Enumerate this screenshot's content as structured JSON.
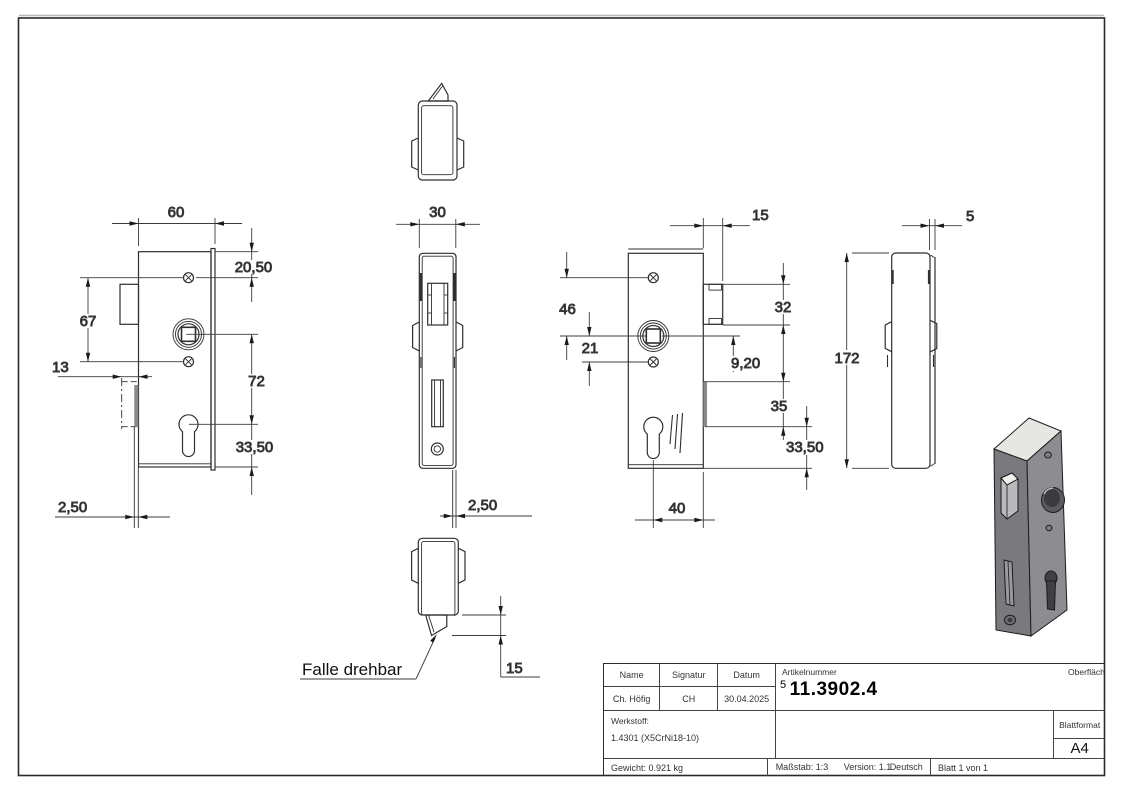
{
  "title_block": {
    "col_name": "Name",
    "col_signatur": "Signatur",
    "col_datum": "Datum",
    "name": "Ch. Höfig",
    "signatur": "CH",
    "datum": "30.04.2025",
    "artikelnummer_label": "Artikelnummer",
    "artikelnummer_prefix": "5",
    "artikelnummer": "11.3902.4",
    "oberflaeche_label": "Oberfläche:",
    "oberflaeche": "Geschliffen Korn 240",
    "werkstoff_label": "Werkstoff:",
    "werkstoff": "1.4301 (X5CrNi18-10)",
    "gewicht": "Gewicht: 0.921 kg",
    "massstab": "Maßstab: 1:3",
    "version": "Version: 1.1",
    "sprache": "Deutsch",
    "blatt": "Blatt 1 von 1",
    "blattformat_label": "Blattformat",
    "blattformat": "A4"
  },
  "annotations": {
    "falle": "Falle drehbar"
  },
  "dims": {
    "front": {
      "width": "60",
      "top_screw": "20,50",
      "screw_span": "67",
      "latch_depth": "13",
      "spindle_euro": "72",
      "euro_bottom": "33,50",
      "plate": "2,50"
    },
    "side": {
      "width": "30",
      "plate": "2,50"
    },
    "bottom": {
      "latch": "15"
    },
    "back": {
      "latch_offset": "15",
      "screw_spindle": "46",
      "spindle_screw": "21",
      "latch_height": "32",
      "offset": "9,20",
      "bolt": "35",
      "euro_bottom": "33,50",
      "euro_edge": "40"
    },
    "right": {
      "thickness": "5",
      "height": "172"
    }
  }
}
